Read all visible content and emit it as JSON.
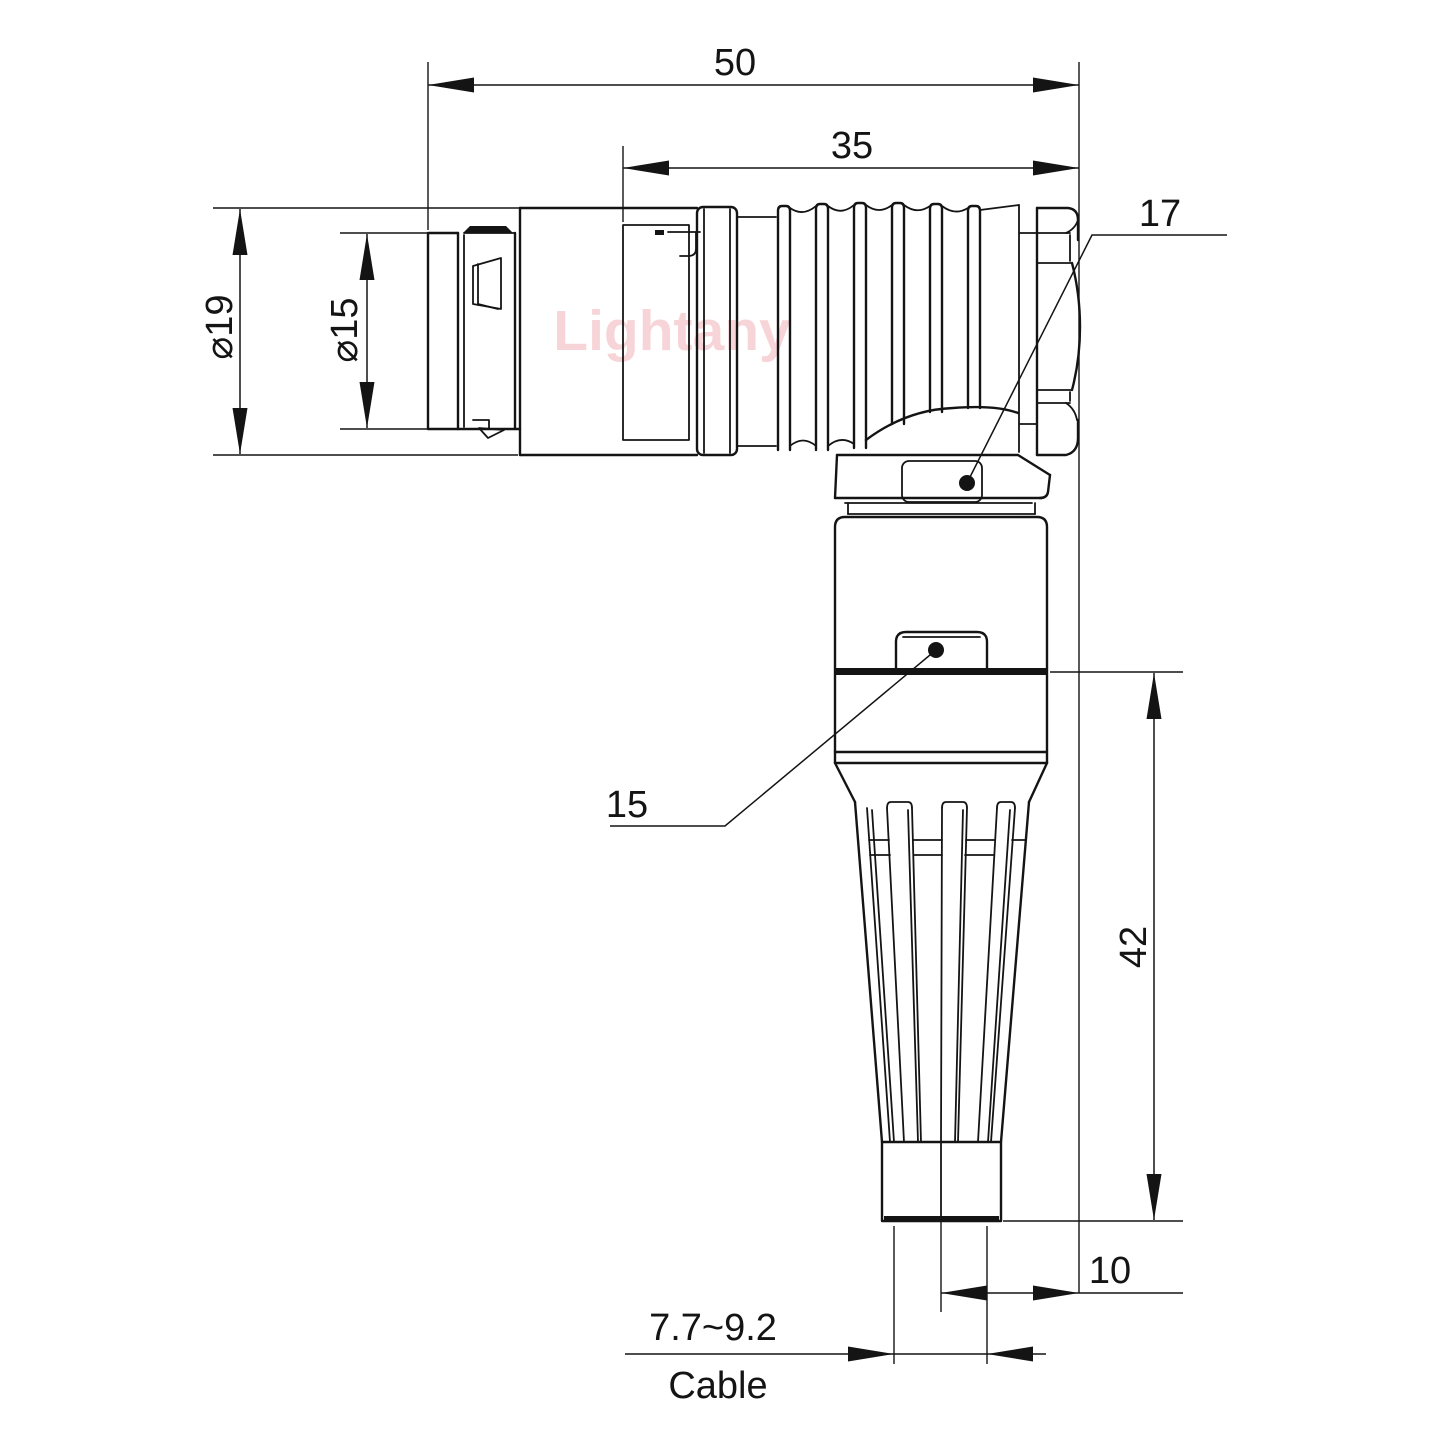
{
  "drawing": {
    "type": "engineering-dimension-drawing",
    "subject": "right-angle circular push-pull connector with bend relief, side view",
    "watermark": {
      "text": "Lightany",
      "color": "#ee9aa1"
    },
    "colors": {
      "line": "#141414",
      "background": "#ffffff"
    },
    "dimensions": {
      "overall_length": "50",
      "rear_length": "35",
      "outer_diameter": "⌀19",
      "front_diameter": "⌀15",
      "nut_across_flats": "17",
      "body_across_flats": "15",
      "vertical_length": "42",
      "axis_offset": "10",
      "cable_range": "7.7~9.2",
      "cable_label": "Cable"
    }
  }
}
